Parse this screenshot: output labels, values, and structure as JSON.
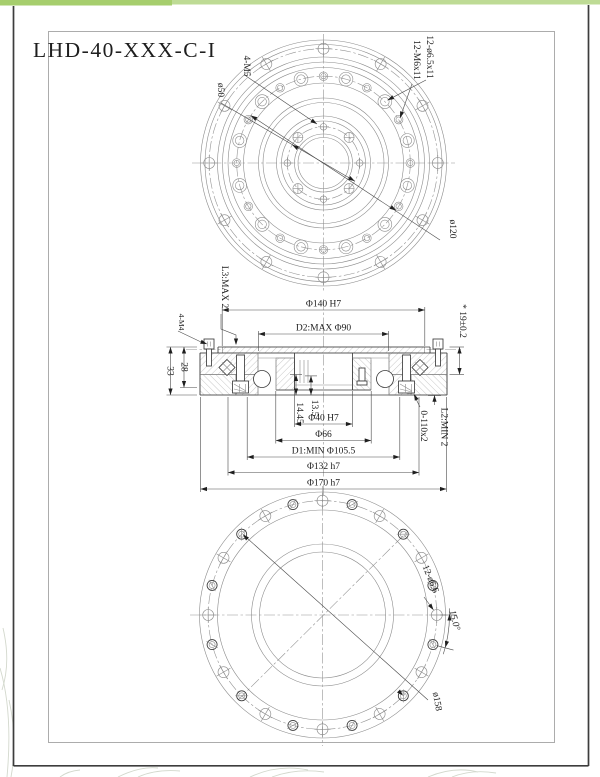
{
  "sheet": {
    "title": "LHD-40-XXX-C-I"
  },
  "colors": {
    "accent_left": "#a6ce6d",
    "accent_right": "#bedb95"
  },
  "top_view": {
    "label_4m5": "4-M5",
    "label_dia50": "ø50",
    "label_cbore_holes": "12-ø6.5x11",
    "label_tapped_holes": "12-M6x11",
    "label_dia120": "ø120"
  },
  "section_view": {
    "label_l3": "L3:MAX 2",
    "label_4m4": "4-M4",
    "dim_dia140": "Φ140 H7",
    "dim_d2": "D2:MAX Φ90",
    "dim_19": "* 19±0.2",
    "dim_33": "33",
    "dim_28": "28",
    "dim_1445": "14.45",
    "dim_135": "13.5",
    "dim_dia40": "Φ40 H7",
    "dim_dia66": "Φ66",
    "dim_d1": "D1:MIN Φ105.5",
    "dim_dia132": "Φ132 h7",
    "dim_dia170": "Φ170 h7",
    "label_oring": "0-110x2",
    "label_l2": "L2:MIN 2"
  },
  "bottom_view": {
    "label_holes": "12-ø6.6",
    "label_angle": "15.0°",
    "label_dia158": "ø158"
  }
}
